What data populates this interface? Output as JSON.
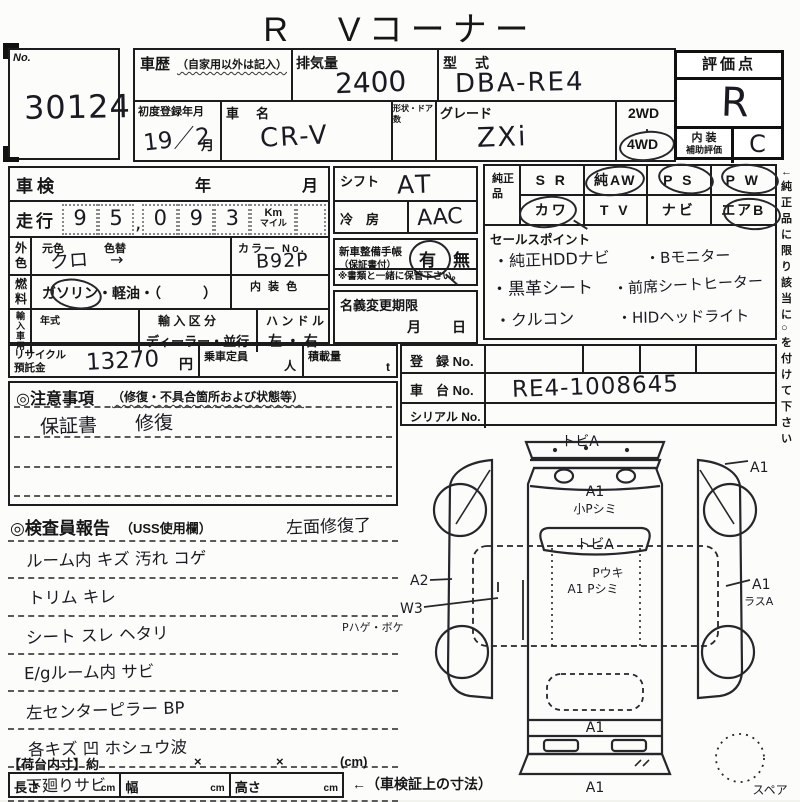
{
  "title": "R　Vコーナー",
  "header": {
    "no_label": "No.",
    "no_value": "30124",
    "history_label": "車歴",
    "history_note": "（自家用以外は記入）",
    "displacement_label": "排気量",
    "displacement_value": "2400",
    "model_code_label": "型　式",
    "model_code_value": "DBA-RE4",
    "first_reg_label": "初度登録年月",
    "first_reg_value": "19／2",
    "first_reg_unit": "月",
    "car_name_label": "車　名",
    "car_name_value": "CR-V",
    "shape_doors_label": "形状・ドア数",
    "grade_label": "グレード",
    "grade_value": "ZXi",
    "drive_2wd": "2WD",
    "drive_dot": "・",
    "drive_4wd": "4WD",
    "score_label": "評価点",
    "score_value": "R",
    "interior_label_1": "内 装",
    "interior_label_2": "補助評価",
    "interior_value": "C"
  },
  "left_panel": {
    "shaken_label": "車検",
    "year_label": "年",
    "month_label": "月",
    "mileage_label": "走行",
    "mileage_digits": [
      "9",
      "5",
      "0",
      "9",
      "3"
    ],
    "mileage_comma": ",",
    "km_label": "Km",
    "mile_label": "マイル",
    "ext_color_label": "外色",
    "orig_color_label": "元色",
    "orig_color_value": "クロ",
    "color_change_label": "色替",
    "color_change_mark": "→",
    "color_no_label": "カラー No.",
    "color_no_value": "B92P",
    "fuel_label": "燃料",
    "fuel_options": "ガソリン・軽油・（　　　）",
    "interior_color_label": "内 装 色",
    "import_label": "輸入車用",
    "year_model_label": "年式",
    "import_class_label": "輸 入 区 分",
    "import_class_value": "ディーラー・並行",
    "handle_label": "ハ ン ド ル",
    "handle_value": "左 ・ 右"
  },
  "center_panel": {
    "shift_label": "シフト",
    "shift_value": "AT",
    "ac_label": "冷　房",
    "ac_value": "AAC",
    "booklet_label_1": "新車整備手帳",
    "booklet_label_2": "（保証書付）",
    "booklet_yes": "有",
    "booklet_no": "無",
    "booklet_note": "※書類と一緒に保管下さい。",
    "transfer_label": "名義変更期限",
    "transfer_month": "月",
    "transfer_day": "日"
  },
  "genuine_parts": {
    "label": "純正品",
    "row1": [
      {
        "label": "S R",
        "circled": false
      },
      {
        "label": "純AW",
        "circled": true
      },
      {
        "label": "P S",
        "circled": true
      },
      {
        "label": "P W",
        "circled": true
      }
    ],
    "row2": [
      {
        "label": "カワ",
        "circled": true
      },
      {
        "label": "T V",
        "circled": false
      },
      {
        "label": "ナビ",
        "circled": false
      },
      {
        "label": "エアB",
        "circled": true
      }
    ],
    "side_note": "←純正品に限り該当に○を付けて下さい"
  },
  "sales_points": {
    "label": "セールスポイント",
    "left_items": [
      "・純正HDDナビ",
      "・黒革シート",
      "・クルコン"
    ],
    "right_items": [
      "・Bモニター",
      "・前席シートヒーター",
      "・HIDヘッドライト"
    ]
  },
  "registration": {
    "reg_no_label": "登　録 No.",
    "chassis_no_label": "車　台 No.",
    "chassis_no_value": "RE4-1008645",
    "serial_no_label": "シリアル No."
  },
  "recycle": {
    "label_1": "リサイクル",
    "label_2": "預託金",
    "value": "13270",
    "unit": "円",
    "capacity_label": "乗車定員",
    "capacity_unit": "人",
    "load_label": "積載量",
    "load_unit": "t"
  },
  "cautions": {
    "header": "◎注意事項",
    "note": "（修復・不具合箇所および状態等）",
    "line1": "保証書　　修復"
  },
  "inspector": {
    "header": "◎検査員報告",
    "note": "（USS使用欄）",
    "side_note": "左面修復了",
    "lines": [
      "ルーム内 キズ 汚れ コゲ",
      "トリム キレ",
      "シート スレ ヘタリ",
      "E/gルーム内 サビ",
      "左センターピラー BP",
      "各キズ 凹 ホシュウ波",
      "下廻りサビ"
    ]
  },
  "bed_size": {
    "label": "【荷台内寸】約",
    "sep1": "×",
    "sep2": "×",
    "unit": "(cm)",
    "length_label": "長さ",
    "width_label": "幅",
    "height_label": "高さ",
    "cm": "cm",
    "ref_note": "←（車検証上の寸法）"
  },
  "diagram": {
    "front_note": "トビA",
    "front_right_note": "A1",
    "hood_note1": "A1",
    "hood_note2": "小Pシミ",
    "windshield_note": "トビA",
    "roof_note1": "Pウキ",
    "roof_note2": "A1 Pシミ",
    "left_note1": "A2",
    "left_note2": "W3",
    "left_note3": "Pハゲ・ボケ",
    "right_note1": "A1",
    "right_note2": "ラスA",
    "rear_note": "A1",
    "rear_bumper_note": "A1",
    "spare_label": "スペア"
  }
}
